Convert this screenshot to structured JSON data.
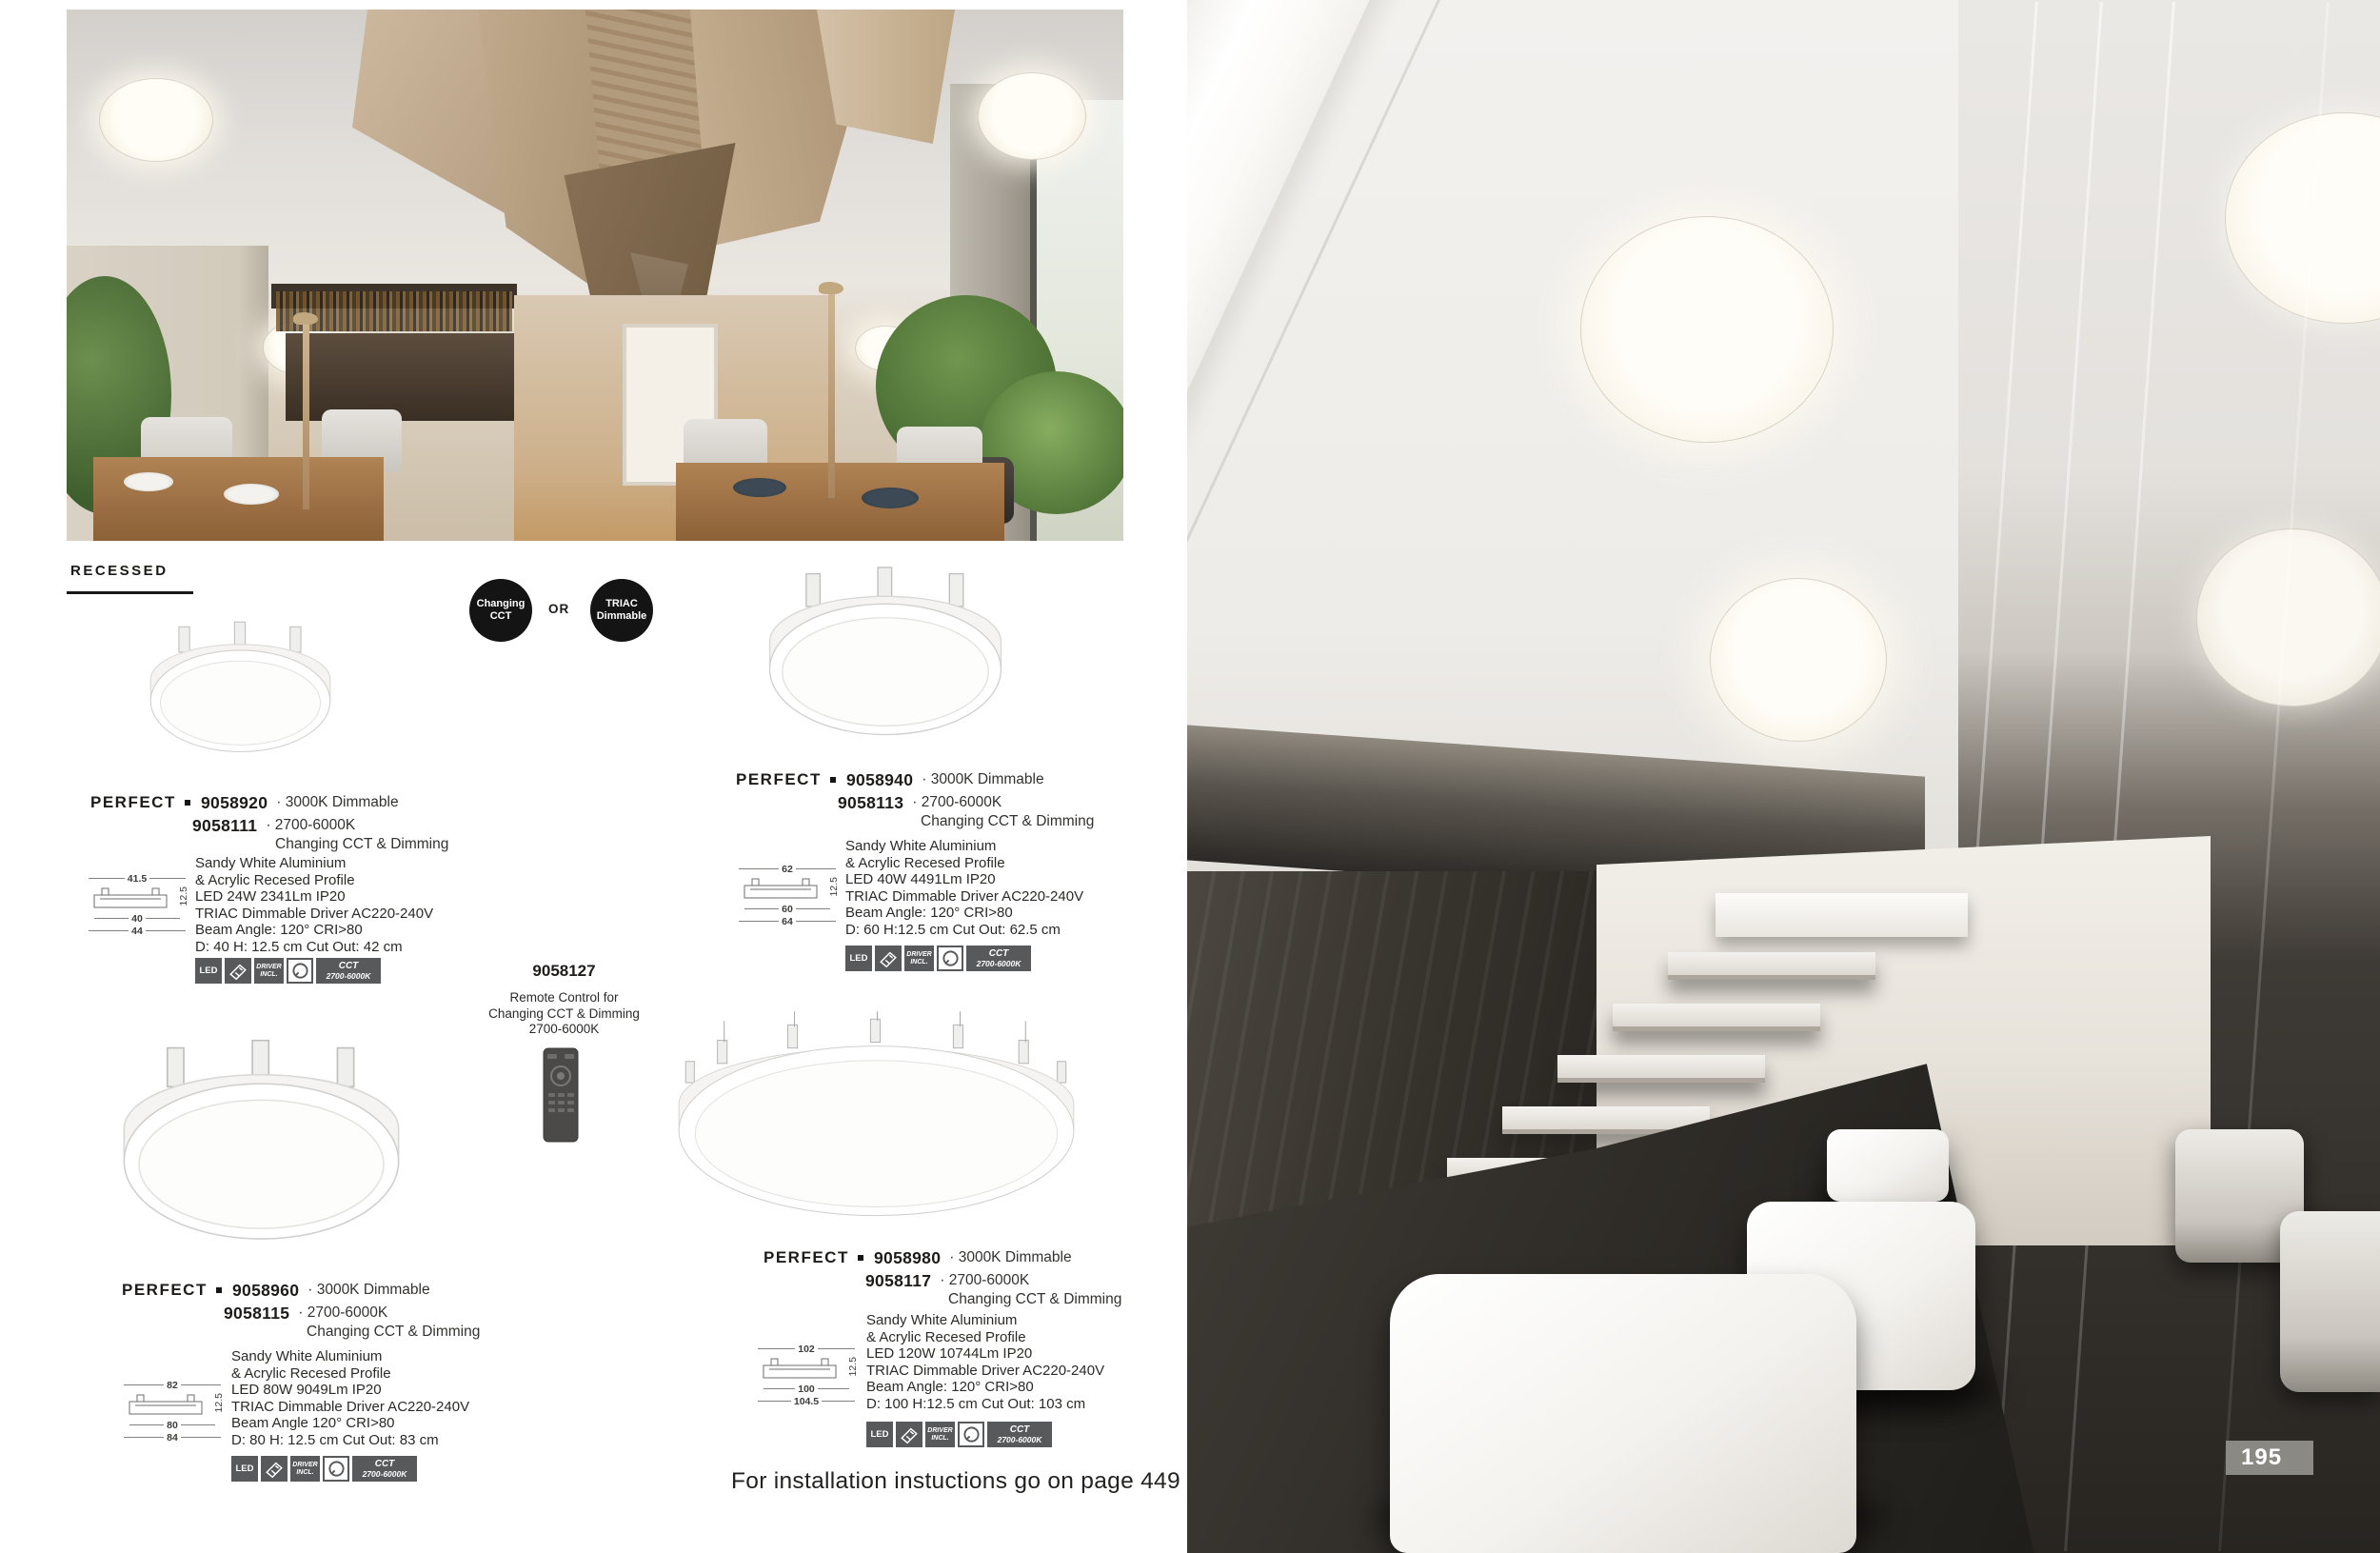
{
  "section_label": "RECESSED",
  "options": {
    "changing_cct": [
      "Changing",
      "CCT"
    ],
    "or": "OR",
    "triac": [
      "TRIAC",
      "Dimmable"
    ]
  },
  "icon_labels": {
    "led": "LED",
    "driver_line1": "DRIVER",
    "driver_line2": "INCL.",
    "cct_line1": "CCT",
    "cct_line2": "2700-6000K"
  },
  "remote": {
    "code": "9058127",
    "desc_line1": "Remote Control for",
    "desc_line2": "Changing CCT & Dimming",
    "desc_line3": "2700-6000K"
  },
  "footer_note": "For installation instuctions go on page 449",
  "page_number": "195",
  "products": [
    {
      "family": "PERFECT",
      "code_a": "9058920",
      "variant_a": "· 3000K Dimmable",
      "code_b": "9058111",
      "variant_b": "· 2700-6000K",
      "variant_b2": "Changing CCT & Dimming",
      "specs": [
        "Sandy White Aluminium",
        "& Acrylic Recesed Profile",
        "LED 24W 2341Lm IP20",
        "TRIAC Dimmable Driver AC220-240V",
        "Beam Angle: 120° CRI>80",
        "D: 40 H: 12.5 cm Cut Out: 42 cm"
      ],
      "dims": {
        "top": "41.5",
        "height": "12.5",
        "middle": "40",
        "bottom": "44"
      }
    },
    {
      "family": "PERFECT",
      "code_a": "9058940",
      "variant_a": "· 3000K Dimmable",
      "code_b": "9058113",
      "variant_b": "· 2700-6000K",
      "variant_b2": "Changing CCT & Dimming",
      "specs": [
        "Sandy White Aluminium",
        "& Acrylic Recesed Profile",
        "LED 40W 4491Lm IP20",
        "TRIAC Dimmable Driver AC220-240V",
        "Beam Angle: 120° CRI>80",
        "D: 60 H:12.5 cm Cut Out: 62.5 cm"
      ],
      "dims": {
        "top": "62",
        "height": "12.5",
        "middle": "60",
        "bottom": "64"
      }
    },
    {
      "family": "PERFECT",
      "code_a": "9058960",
      "variant_a": "· 3000K Dimmable",
      "code_b": "9058115",
      "variant_b": "· 2700-6000K",
      "variant_b2": "Changing CCT & Dimming",
      "specs": [
        "Sandy White Aluminium",
        "& Acrylic Recesed Profile",
        "LED 80W 9049Lm IP20",
        "TRIAC Dimmable Driver AC220-240V",
        "Beam Angle 120° CRI>80",
        "D: 80 H: 12.5 cm Cut Out: 83 cm"
      ],
      "dims": {
        "top": "82",
        "height": "12.5",
        "middle": "80",
        "bottom": "84"
      }
    },
    {
      "family": "PERFECT",
      "code_a": "9058980",
      "variant_a": "· 3000K Dimmable",
      "code_b": "9058117",
      "variant_b": "· 2700-6000K",
      "variant_b2": "Changing CCT & Dimming",
      "specs": [
        "Sandy White Aluminium",
        "& Acrylic Recesed Profile",
        "LED 120W 10744Lm IP20",
        "TRIAC Dimmable Driver AC220-240V",
        "Beam Angle: 120° CRI>80",
        "D: 100 H:12.5 cm Cut Out: 103 cm"
      ],
      "dims": {
        "top": "102",
        "height": "12.5",
        "middle": "100",
        "bottom": "104.5"
      }
    }
  ]
}
